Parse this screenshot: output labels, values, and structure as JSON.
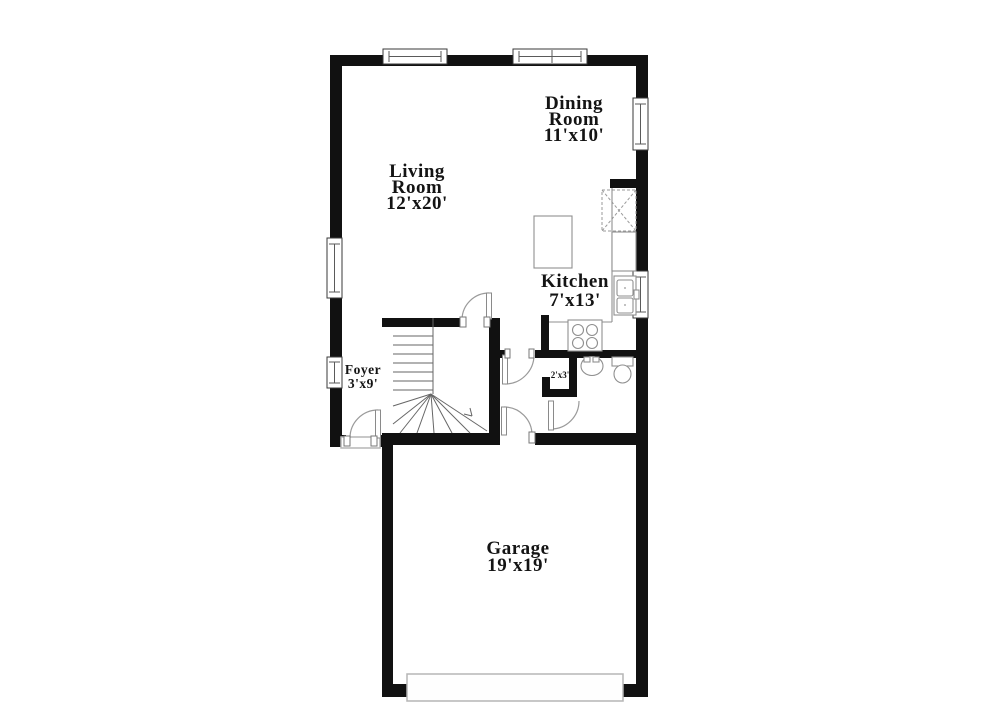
{
  "title": "First floor plan",
  "colors": {
    "wall": "#111111",
    "line": "#8f8f8f",
    "stair": "#666666",
    "text": "#141414",
    "bg": "#ffffff"
  },
  "rooms": {
    "living": {
      "name": "Living Room",
      "dims": "12'x20'",
      "lines": [
        "Living",
        "Room",
        "12'x20'"
      ]
    },
    "dining": {
      "name": "Dining Room",
      "dims": "11'x10'",
      "lines": [
        "Dining",
        "Room",
        "11'x10'"
      ]
    },
    "kitchen": {
      "name": "Kitchen",
      "dims": "7'x13'",
      "lines": [
        "Kitchen",
        "7'x13'"
      ]
    },
    "foyer": {
      "name": "Foyer",
      "dims": "3'x9'",
      "lines": [
        "Foyer",
        "3'x9'"
      ]
    },
    "garage": {
      "name": "Garage",
      "dims": "19'x19'",
      "lines": [
        "Garage",
        "19'x19'"
      ]
    },
    "closet": {
      "name": "Closet",
      "dims": "2'x3'",
      "lines": [
        "2'x3'"
      ]
    }
  },
  "fixtures": [
    "staircase-with-winders",
    "pantry-closet-x",
    "refrigerator",
    "kitchen-double-sink",
    "kitchen-island",
    "stove-four-burners",
    "powder-room-sink",
    "toilet",
    "front-door",
    "garage-overhead-door",
    "interior-swing-doors",
    "windows"
  ]
}
